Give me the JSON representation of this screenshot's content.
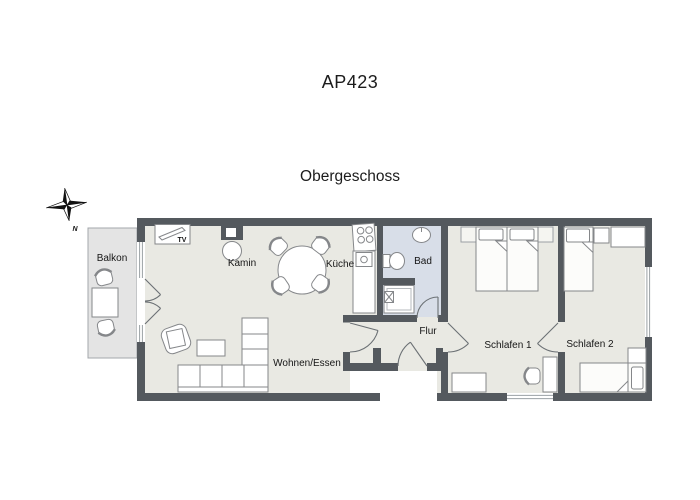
{
  "header": {
    "title": "AP423",
    "subtitle": "Obergeschoss"
  },
  "compass": {
    "north_label": "N"
  },
  "rooms": {
    "balkon": "Balkon",
    "wohnen_essen": "Wohnen/Essen",
    "kamin": "Kamin",
    "kueche": "Küche",
    "bad": "Bad",
    "flur": "Flur",
    "schlafen1": "Schlafen 1",
    "schlafen2": "Schlafen 2"
  },
  "furniture_labels": {
    "tv": "TV"
  },
  "colors": {
    "wall": "#54595e",
    "room_floor": "#e9e9e3",
    "bath_floor": "#d8dee8",
    "balcony_floor": "#e4e4e4",
    "furniture_stroke": "#85878a",
    "text": "#161616"
  }
}
